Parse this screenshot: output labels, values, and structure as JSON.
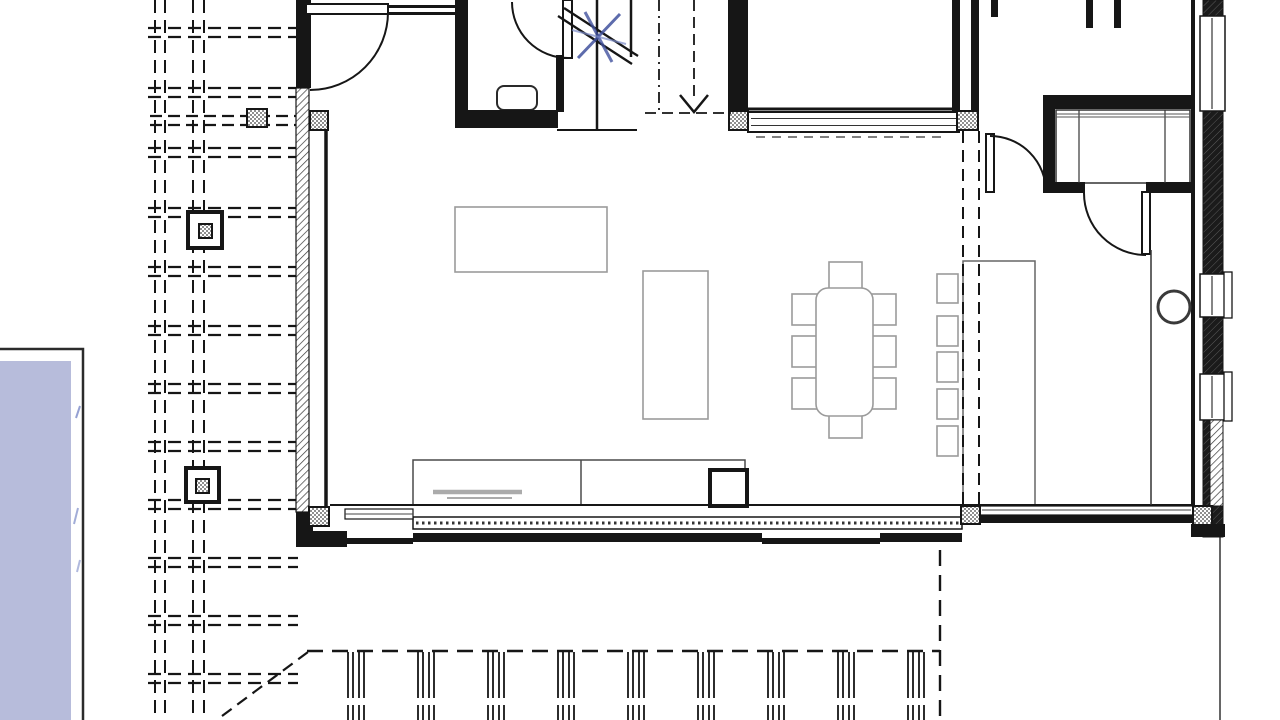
{
  "meta": {
    "type": "architectural-floor-plan",
    "canvas_w": 1280,
    "canvas_h": 720
  },
  "colors": {
    "line": "#161616",
    "furn": "#9b9b9b",
    "blue": "#41519e",
    "blue_light": "#7b8ac8",
    "pool": "#b7bcdb",
    "gray_mid": "#ababab"
  },
  "drawing": {
    "pergola": {
      "verticals": [
        155,
        165,
        193,
        204
      ],
      "beam_rows": [
        28,
        88,
        148,
        208,
        267,
        326,
        384,
        442,
        500,
        558,
        616,
        674
      ],
      "beam_x1": 148,
      "beam_x2": 298,
      "beam_gap": 9,
      "dash": "13 7",
      "porch_beam": {
        "y1": 116,
        "y2": 125,
        "x1": 150,
        "x2": 298
      },
      "piers": [
        {
          "x": 188,
          "y": 212,
          "w": 34,
          "h": 36,
          "ix": 199,
          "iy": 224,
          "iw": 13,
          "ih": 14
        },
        {
          "x": 186,
          "y": 468,
          "w": 33,
          "h": 34,
          "ix": 196,
          "iy": 479,
          "iw": 13,
          "ih": 14
        }
      ]
    },
    "pool": {
      "x": -28,
      "y": 349,
      "w": 111,
      "h": 378,
      "wx": -28,
      "wy": 361,
      "ww": 99,
      "wh": 366
    },
    "deck": {
      "edge": {
        "x1": 307,
        "y1": 651,
        "x2": 940,
        "y2": 651
      },
      "right": {
        "x1": 940,
        "y1": 550,
        "x2": 940,
        "y2": 722
      },
      "diagonal": {
        "x1": 222,
        "y1": 716,
        "x2": 308,
        "y2": 652
      },
      "outer_line": {
        "x1": 1220,
        "y1": 537,
        "x2": 1220,
        "y2": 722
      },
      "posts": {
        "x0": 348,
        "dx": 70,
        "n": 9,
        "y1": 652,
        "y2": 722,
        "offsets": [
          0,
          5,
          11,
          16
        ]
      },
      "dash": "16 9"
    },
    "rects": [
      {
        "x": 829,
        "y": 262,
        "w": 33,
        "h": 29,
        "f": "#fff",
        "s": "furn",
        "sw": 1.6,
        "n": "dining-chair"
      },
      {
        "x": 829,
        "y": 407,
        "w": 33,
        "h": 31,
        "f": "#fff",
        "s": "furn",
        "sw": 1.6,
        "n": "dining-chair"
      },
      {
        "x": 792,
        "y": 294,
        "w": 34,
        "h": 31,
        "f": "#fff",
        "s": "furn",
        "sw": 1.6,
        "n": "dining-chair"
      },
      {
        "x": 792,
        "y": 336,
        "w": 34,
        "h": 31,
        "f": "#fff",
        "s": "furn",
        "sw": 1.6,
        "n": "dining-chair"
      },
      {
        "x": 792,
        "y": 378,
        "w": 34,
        "h": 31,
        "f": "#fff",
        "s": "furn",
        "sw": 1.6,
        "n": "dining-chair"
      },
      {
        "x": 862,
        "y": 294,
        "w": 34,
        "h": 31,
        "f": "#fff",
        "s": "furn",
        "sw": 1.6,
        "n": "dining-chair"
      },
      {
        "x": 862,
        "y": 336,
        "w": 34,
        "h": 31,
        "f": "#fff",
        "s": "furn",
        "sw": 1.6,
        "n": "dining-chair"
      },
      {
        "x": 862,
        "y": 378,
        "w": 34,
        "h": 31,
        "f": "#fff",
        "s": "furn",
        "sw": 1.6,
        "n": "dining-chair"
      },
      {
        "x": 816,
        "y": 288,
        "w": 57,
        "h": 128,
        "rx": 12,
        "f": "#fff",
        "s": "furn",
        "sw": 1.6,
        "n": "dining-table"
      },
      {
        "x": 455,
        "y": 207,
        "w": 152,
        "h": 65,
        "f": "#fff",
        "s": "furn",
        "sw": 1.6,
        "n": "sofa"
      },
      {
        "x": 643,
        "y": 271,
        "w": 65,
        "h": 148,
        "f": "#fff",
        "s": "furn",
        "sw": 1.6,
        "n": "sideboard"
      },
      {
        "x": 937,
        "y": 274,
        "w": 21,
        "h": 29,
        "f": "#fff",
        "s": "furn",
        "sw": 1.6,
        "n": "bar-stool"
      },
      {
        "x": 937,
        "y": 316,
        "w": 21,
        "h": 30,
        "f": "#fff",
        "s": "furn",
        "sw": 1.6,
        "n": "bar-stool"
      },
      {
        "x": 937,
        "y": 352,
        "w": 21,
        "h": 30,
        "f": "#fff",
        "s": "furn",
        "sw": 1.6,
        "n": "bar-stool"
      },
      {
        "x": 937,
        "y": 389,
        "w": 21,
        "h": 30,
        "f": "#fff",
        "s": "furn",
        "sw": 1.6,
        "n": "bar-stool"
      },
      {
        "x": 937,
        "y": 426,
        "w": 21,
        "h": 30,
        "f": "#fff",
        "s": "furn",
        "sw": 1.6,
        "n": "bar-stool"
      },
      {
        "x": 963,
        "y": 261,
        "w": 72,
        "h": 246,
        "f": "#fff",
        "s": "#666666",
        "sw": 1.5,
        "n": "kitchen-island"
      },
      {
        "x": 413,
        "y": 460,
        "w": 332,
        "h": 45,
        "f": "#fff",
        "s": "#4a4a4a",
        "sw": 1.5,
        "n": "kitchen-counter"
      },
      {
        "x": 710,
        "y": 470,
        "w": 37,
        "h": 36,
        "f": "#fff",
        "s": "line",
        "sw": 4,
        "n": "stove"
      },
      {
        "x": 497,
        "y": 86,
        "w": 40,
        "h": 24,
        "rx": 7,
        "f": "#fff",
        "s": "#2a2a2a",
        "sw": 2,
        "n": "toilet"
      },
      {
        "x": 1056,
        "y": 110,
        "w": 134,
        "h": 73,
        "f": "#fff",
        "s": "#333333",
        "sw": 1.5,
        "n": "wardrobe"
      },
      {
        "x": 296,
        "y": 0,
        "w": 15,
        "h": 88,
        "f": "line",
        "n": "wall-west-top"
      },
      {
        "x": 296,
        "y": 512,
        "w": 17,
        "h": 35,
        "f": "line",
        "n": "wall-west-bottom"
      },
      {
        "x": 386,
        "y": 5,
        "w": 73,
        "h": 3,
        "f": "line",
        "n": "wall-north-entry"
      },
      {
        "x": 386,
        "y": 12,
        "w": 73,
        "h": 3,
        "f": "line",
        "n": "wall-north-entry"
      },
      {
        "x": 455,
        "y": 0,
        "w": 13,
        "h": 112,
        "f": "line",
        "n": "wall-bathroom-west"
      },
      {
        "x": 455,
        "y": 110,
        "w": 103,
        "h": 18,
        "f": "line",
        "n": "wall-bathroom-south"
      },
      {
        "x": 556,
        "y": 55,
        "w": 8,
        "h": 57,
        "f": "line",
        "n": "wall-stair-west"
      },
      {
        "x": 728,
        "y": 0,
        "w": 20,
        "h": 110,
        "f": "line",
        "n": "wall-stair-east"
      },
      {
        "x": 952,
        "y": 0,
        "w": 8,
        "h": 112,
        "f": "line",
        "n": "wall-room-east"
      },
      {
        "x": 971,
        "y": 0,
        "w": 8,
        "h": 112,
        "f": "line",
        "n": "wall-room-east"
      },
      {
        "x": 991,
        "y": 0,
        "w": 7,
        "h": 17,
        "f": "line",
        "n": "wall-stub"
      },
      {
        "x": 1086,
        "y": 0,
        "w": 7,
        "h": 28,
        "f": "line",
        "n": "wall-stub"
      },
      {
        "x": 1114,
        "y": 0,
        "w": 7,
        "h": 28,
        "f": "line",
        "n": "wall-stub"
      },
      {
        "x": 1043,
        "y": 95,
        "w": 149,
        "h": 14,
        "f": "line",
        "n": "wall-closet-north"
      },
      {
        "x": 1043,
        "y": 95,
        "w": 12,
        "h": 97,
        "f": "line",
        "n": "wall-closet-west"
      },
      {
        "x": 1043,
        "y": 182,
        "w": 42,
        "h": 11,
        "f": "line",
        "n": "wall-closet-south"
      },
      {
        "x": 1146,
        "y": 182,
        "w": 46,
        "h": 11,
        "f": "line",
        "n": "wall-closet-south"
      },
      {
        "x": 1191,
        "y": 0,
        "w": 4,
        "h": 507,
        "f": "line",
        "n": "wall-east-inner"
      },
      {
        "x": 1203,
        "y": 0,
        "w": 20,
        "h": 537,
        "f": "url:wallhatch",
        "s": "line",
        "sw": 1,
        "n": "wall-east"
      },
      {
        "x": 1191,
        "y": 524,
        "w": 34,
        "h": 13,
        "f": "line",
        "n": "wall-corner-se"
      },
      {
        "x": 980,
        "y": 514,
        "w": 213,
        "h": 9,
        "f": "line",
        "n": "wall-south-hall"
      },
      {
        "x": 298,
        "y": 531,
        "w": 49,
        "h": 16,
        "f": "line",
        "n": "wall-sill-south"
      },
      {
        "x": 347,
        "y": 538,
        "w": 66,
        "h": 6,
        "f": "line",
        "n": "wall-sill-south"
      },
      {
        "x": 413,
        "y": 533,
        "w": 349,
        "h": 9,
        "f": "line",
        "n": "wall-sill-south"
      },
      {
        "x": 762,
        "y": 538,
        "w": 118,
        "h": 6,
        "f": "line",
        "n": "wall-sill-south"
      },
      {
        "x": 880,
        "y": 533,
        "w": 82,
        "h": 9,
        "f": "line",
        "n": "wall-sill-south"
      },
      {
        "x": 748,
        "y": 112,
        "w": 211,
        "h": 20,
        "f": "#fff",
        "s": "line",
        "sw": 2,
        "n": "window-band-north"
      },
      {
        "x": 296,
        "y": 88,
        "w": 13,
        "h": 424,
        "f": "url:glaz",
        "s": "line",
        "sw": 1.2,
        "n": "window-west"
      },
      {
        "x": 413,
        "y": 517,
        "w": 549,
        "h": 12,
        "f": "#fff",
        "s": "line",
        "sw": 1.5,
        "n": "sliding-door-south"
      },
      {
        "x": 345,
        "y": 509,
        "w": 68,
        "h": 10,
        "f": "#fff",
        "s": "line",
        "sw": 1.2,
        "n": "window-south-left"
      },
      {
        "x": 980,
        "y": 506,
        "w": 213,
        "h": 9,
        "f": "#fff",
        "s": "line",
        "sw": 1.2,
        "n": "window-south-hall"
      },
      {
        "x": 1200,
        "y": 16,
        "w": 25,
        "h": 95,
        "f": "#fff",
        "s": "line",
        "sw": 1.5,
        "n": "window-east"
      },
      {
        "x": 1200,
        "y": 274,
        "w": 25,
        "h": 43,
        "f": "#fff",
        "s": "line",
        "sw": 1.5,
        "n": "window-east"
      },
      {
        "x": 1200,
        "y": 374,
        "w": 25,
        "h": 46,
        "f": "#fff",
        "s": "line",
        "sw": 1.5,
        "n": "window-east"
      },
      {
        "x": 1224,
        "y": 272,
        "w": 8,
        "h": 46,
        "f": "#fff",
        "s": "line",
        "sw": 1.3,
        "n": "window-sill-tab"
      },
      {
        "x": 1224,
        "y": 372,
        "w": 8,
        "h": 49,
        "f": "#fff",
        "s": "line",
        "sw": 1.3,
        "n": "window-sill-tab"
      },
      {
        "x": 1210,
        "y": 420,
        "w": 13,
        "h": 86,
        "f": "url:glaz",
        "s": "line",
        "sw": 1,
        "n": "window-east"
      },
      {
        "x": 306,
        "y": 4,
        "w": 82,
        "h": 10,
        "f": "#fff",
        "s": "line",
        "sw": 2,
        "n": "entry-door-leaf"
      },
      {
        "x": 563,
        "y": 0,
        "w": 9,
        "h": 58,
        "f": "#fff",
        "s": "line",
        "sw": 2,
        "n": "bathroom-door-leaf"
      },
      {
        "x": 986,
        "y": 134,
        "w": 8,
        "h": 58,
        "f": "#fff",
        "s": "line",
        "sw": 2,
        "n": "hall-door-leaf"
      },
      {
        "x": 1142,
        "y": 192,
        "w": 8,
        "h": 62,
        "f": "#fff",
        "s": "line",
        "sw": 2,
        "n": "closet-door-leaf"
      }
    ],
    "columns": [
      {
        "x": 310,
        "y": 111,
        "w": 18,
        "h": 19
      },
      {
        "x": 729,
        "y": 111,
        "w": 19,
        "h": 19
      },
      {
        "x": 957,
        "y": 111,
        "w": 21,
        "h": 19
      },
      {
        "x": 247,
        "y": 109,
        "w": 20,
        "h": 18
      },
      {
        "x": 309,
        "y": 507,
        "w": 20,
        "h": 19
      },
      {
        "x": 961,
        "y": 506,
        "w": 19,
        "h": 18
      },
      {
        "x": 1193,
        "y": 506,
        "w": 19,
        "h": 19
      }
    ],
    "lines": [
      {
        "x1": 728,
        "y1": 109,
        "x2": 958,
        "y2": 109,
        "s": "line",
        "sw": 3,
        "n": "wall-face-north"
      },
      {
        "x1": 751,
        "y1": 118.5,
        "x2": 956,
        "y2": 118.5,
        "s": "#333333",
        "sw": 1,
        "n": "window-glazing-line"
      },
      {
        "x1": 751,
        "y1": 125.5,
        "x2": 956,
        "y2": 125.5,
        "s": "#333333",
        "sw": 1,
        "n": "window-glazing-line"
      },
      {
        "x1": 756,
        "y1": 137,
        "x2": 948,
        "y2": 137,
        "s": "#555555",
        "sw": 1.5,
        "d": "9 7",
        "n": "window-sill-dashes"
      },
      {
        "x1": 581,
        "y1": 460,
        "x2": 581,
        "y2": 505,
        "s": "#4a4a4a",
        "sw": 1.5,
        "n": "counter-divider"
      },
      {
        "x1": 433,
        "y1": 492,
        "x2": 522,
        "y2": 492,
        "s": "gray_mid",
        "sw": 4.5,
        "n": "sink"
      },
      {
        "x1": 447,
        "y1": 498,
        "x2": 512,
        "y2": 498,
        "s": "gray_mid",
        "sw": 2,
        "n": "sink"
      },
      {
        "x1": 1079,
        "y1": 110,
        "x2": 1079,
        "y2": 183,
        "s": "#333333",
        "sw": 1.2,
        "n": "wardrobe-divider"
      },
      {
        "x1": 1165,
        "y1": 110,
        "x2": 1165,
        "y2": 183,
        "s": "#333333",
        "sw": 1.2,
        "n": "wardrobe-divider"
      },
      {
        "x1": 1056,
        "y1": 114,
        "x2": 1190,
        "y2": 114,
        "s": "#555555",
        "sw": 1,
        "n": "wardrobe-rod"
      },
      {
        "x1": 1056,
        "y1": 117,
        "x2": 1190,
        "y2": 117,
        "s": "#555555",
        "sw": 1,
        "n": "wardrobe-rod"
      },
      {
        "x1": 326,
        "y1": 130,
        "x2": 326,
        "y2": 507,
        "s": "line",
        "sw": 3.5,
        "n": "wall-face-west"
      },
      {
        "x1": 330,
        "y1": 505,
        "x2": 1191,
        "y2": 505,
        "s": "line",
        "sw": 2,
        "n": "wall-face-south"
      },
      {
        "x1": 557,
        "y1": 130,
        "x2": 637,
        "y2": 130,
        "s": "line",
        "sw": 2,
        "n": "stair-landing-edge"
      },
      {
        "x1": 1151,
        "y1": 250,
        "x2": 1151,
        "y2": 505,
        "s": "#333333",
        "sw": 1.5,
        "n": "hall-edge-line"
      },
      {
        "x1": 963,
        "y1": 131,
        "x2": 963,
        "y2": 505,
        "s": "line",
        "sw": 2,
        "d": "12 7",
        "n": "column-grid-line"
      },
      {
        "x1": 979,
        "y1": 131,
        "x2": 979,
        "y2": 505,
        "s": "line",
        "sw": 2,
        "d": "12 7",
        "n": "column-grid-line"
      },
      {
        "x1": 597,
        "y1": 0,
        "x2": 597,
        "y2": 130,
        "s": "line",
        "sw": 2.5,
        "n": "stair-stringer"
      },
      {
        "x1": 631,
        "y1": 0,
        "x2": 631,
        "y2": 57,
        "s": "line",
        "sw": 2.5,
        "n": "stair-stringer"
      },
      {
        "x1": 558,
        "y1": 16,
        "x2": 632,
        "y2": 64,
        "s": "line",
        "sw": 2.3,
        "n": "stair-break-line"
      },
      {
        "x1": 564,
        "y1": 8,
        "x2": 638,
        "y2": 56,
        "s": "line",
        "sw": 2.3,
        "n": "stair-break-line"
      },
      {
        "x1": 659,
        "y1": 0,
        "x2": 659,
        "y2": 113,
        "s": "line",
        "sw": 1.8,
        "d": "11 5 2 5",
        "n": "stair-boundary"
      },
      {
        "x1": 694,
        "y1": 0,
        "x2": 694,
        "y2": 97,
        "s": "line",
        "sw": 1.8,
        "d": "11 6",
        "n": "stair-direction-line"
      },
      {
        "x1": 645,
        "y1": 113,
        "x2": 731,
        "y2": 113,
        "s": "line",
        "sw": 1.8,
        "d": "11 6",
        "n": "stair-boundary"
      },
      {
        "x1": 1212,
        "y1": 18,
        "x2": 1212,
        "y2": 109,
        "s": "#333333",
        "sw": 1.2,
        "n": "window-glazing-line"
      },
      {
        "x1": 1212,
        "y1": 276,
        "x2": 1212,
        "y2": 315,
        "s": "#333333",
        "sw": 1.2,
        "n": "window-glazing-line"
      },
      {
        "x1": 1212,
        "y1": 376,
        "x2": 1212,
        "y2": 418,
        "s": "#333333",
        "sw": 1.2,
        "n": "window-glazing-line"
      },
      {
        "x1": 416,
        "y1": 523,
        "x2": 959,
        "y2": 523,
        "s": "#333333",
        "sw": 3,
        "d": "2.5 3.5",
        "n": "sliding-door-track"
      },
      {
        "x1": 345,
        "y1": 514,
        "x2": 413,
        "y2": 514,
        "s": "#444444",
        "sw": 1,
        "n": "window-glazing-line"
      },
      {
        "x1": 982,
        "y1": 510,
        "x2": 1191,
        "y2": 510,
        "s": "#444444",
        "sw": 1,
        "n": "window-glazing-line"
      },
      {
        "x1": 578,
        "y1": 58,
        "x2": 620,
        "y2": 14,
        "s": "blue",
        "sw": 3,
        "o": 0.85,
        "n": "pen-markup"
      },
      {
        "x1": 585,
        "y1": 12,
        "x2": 612,
        "y2": 62,
        "s": "blue",
        "sw": 3,
        "o": 0.8,
        "n": "pen-markup"
      },
      {
        "x1": 572,
        "y1": 30,
        "x2": 626,
        "y2": 44,
        "s": "blue_light",
        "sw": 2,
        "o": 0.7,
        "n": "pen-markup"
      },
      {
        "x1": 80,
        "y1": 406,
        "x2": 76,
        "y2": 418,
        "s": "blue_light",
        "sw": 2,
        "o": 0.8,
        "n": "pen-markup"
      },
      {
        "x1": 78,
        "y1": 508,
        "x2": 74,
        "y2": 524,
        "s": "blue_light",
        "sw": 2,
        "o": 0.7,
        "n": "pen-markup"
      },
      {
        "x1": 80,
        "y1": 560,
        "x2": 77,
        "y2": 572,
        "s": "blue_light",
        "sw": 2,
        "o": 0.6,
        "n": "pen-markup"
      }
    ],
    "paths": [
      {
        "d": "M 388 12 A 78 78 0 0 1 310 90",
        "s": "line",
        "sw": 2,
        "n": "entry-door-swing"
      },
      {
        "d": "M 512 2 A 56 56 0 0 0 568 58",
        "s": "line",
        "sw": 2,
        "n": "bathroom-door-swing"
      },
      {
        "d": "M 990 136 A 56 56 0 0 1 1046 192",
        "s": "line",
        "sw": 2,
        "n": "hall-door-swing"
      },
      {
        "d": "M 1084 193 A 62 62 0 0 0 1146 255",
        "s": "line",
        "sw": 2,
        "n": "closet-door-swing"
      },
      {
        "d": "M 680 95 L 694 112 L 708 95",
        "s": "line",
        "sw": 2.5,
        "n": "stair-arrow-head"
      }
    ],
    "circles": [
      {
        "cx": 1174,
        "cy": 307,
        "r": 16,
        "s": "#3a3a3a",
        "sw": 3,
        "f": "#fff",
        "n": "round-column"
      }
    ]
  }
}
